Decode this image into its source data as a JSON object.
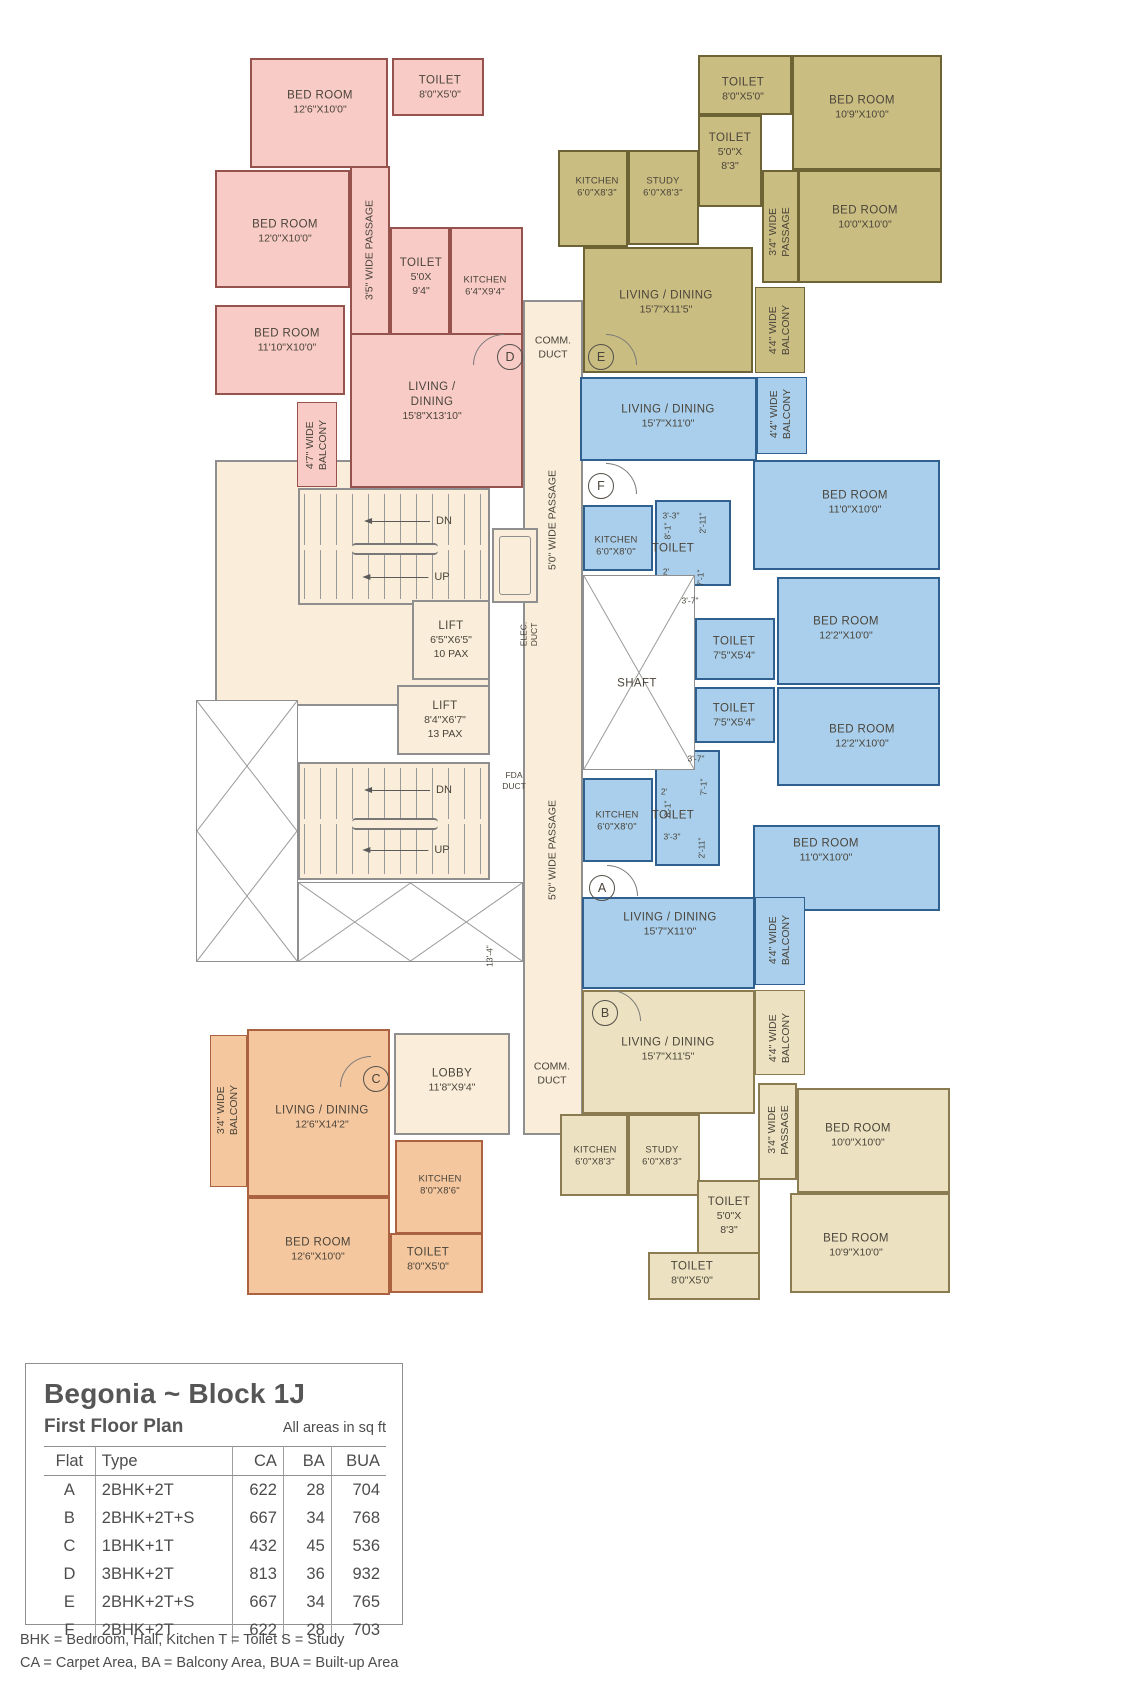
{
  "plan": {
    "flats": {
      "d": {
        "letter": "D",
        "bed1": {
          "name": "BED ROOM",
          "dims": "12'6\"X10'0\""
        },
        "toilet1": {
          "name": "TOILET",
          "dims": "8'0\"X5'0\""
        },
        "passage": "3'5\" WIDE PASSAGE",
        "bed2": {
          "name": "BED ROOM",
          "dims": "12'0\"X10'0\""
        },
        "toilet2": {
          "name": "TOILET",
          "l1": "5'0X",
          "l2": "9'4\""
        },
        "kitchen": {
          "name": "KITCHEN",
          "dims": "6'4\"X9'4\""
        },
        "bed3": {
          "name": "BED ROOM",
          "dims": "11'10\"X10'0\""
        },
        "balcony": "4'7\" WIDE\nBALCONY",
        "living": {
          "l1": "LIVING /",
          "l2": "DINING",
          "dims": "15'8\"X13'10\""
        }
      },
      "e": {
        "letter": "E",
        "toilet1": {
          "name": "TOILET",
          "dims": "8'0\"X5'0\""
        },
        "bed1": {
          "name": "BED ROOM",
          "dims": "10'9\"X10'0\""
        },
        "toilet2": {
          "name": "TOILET",
          "l1": "5'0\"X",
          "l2": "8'3\""
        },
        "kitchen": {
          "name": "KITCHEN",
          "dims": "6'0\"X8'3\""
        },
        "study": {
          "name": "STUDY",
          "dims": "6'0\"X8'3\""
        },
        "passage": "3'4\" WIDE\nPASSAGE",
        "bed2": {
          "name": "BED ROOM",
          "dims": "10'0\"X10'0\""
        },
        "living": {
          "l1": "LIVING / DINING",
          "dims": "15'7\"X11'5\""
        },
        "balcony": "4'4\" WIDE\nBALCONY"
      },
      "f": {
        "letter": "F",
        "living": {
          "l1": "LIVING / DINING",
          "dims": "15'7\"X11'0\""
        },
        "balcony": "4'4\" WIDE\nBALCONY",
        "bed1": {
          "name": "BED ROOM",
          "dims": "11'0\"X10'0\""
        },
        "kitchen": {
          "name": "KITCHEN",
          "dims": "6'0\"X8'0\""
        },
        "toilet": {
          "name": "TOILET",
          "d1": "3'-3\"",
          "d2": "8'-1\"",
          "d3": "2'-11\"",
          "d4": "2'",
          "d5": "7'-1\"",
          "d6": "3'-7\""
        },
        "toilet2": {
          "name": "TOILET",
          "dims": "7'5\"X5'4\""
        },
        "bed2": {
          "name": "BED ROOM",
          "dims": "12'2\"X10'0\""
        }
      },
      "a": {
        "letter": "A",
        "toilet2": {
          "name": "TOILET",
          "dims": "7'5\"X5'4\""
        },
        "bed1": {
          "name": "BED ROOM",
          "dims": "12'2\"X10'0\""
        },
        "kitchen": {
          "name": "KITCHEN",
          "dims": "6'0\"X8'0\""
        },
        "toilet": {
          "name": "TOILET",
          "d1": "3'-3\"",
          "d2": "8'-1\"",
          "d3": "2'-11\"",
          "d4": "2'",
          "d5": "7'-1\"",
          "d6": "3'-7\""
        },
        "bed2": {
          "name": "BED ROOM",
          "dims": "11'0\"X10'0\""
        },
        "living": {
          "l1": "LIVING / DINING",
          "dims": "15'7\"X11'0\""
        },
        "balcony": "4'4\" WIDE\nBALCONY"
      },
      "b": {
        "letter": "B",
        "living": {
          "l1": "LIVING / DINING",
          "dims": "15'7\"X11'5\""
        },
        "balcony": "4'4\" WIDE\nBALCONY",
        "kitchen": {
          "name": "KITCHEN",
          "dims": "6'0\"X8'3\""
        },
        "study": {
          "name": "STUDY",
          "dims": "6'0\"X8'3\""
        },
        "passage": "3'4\" WIDE\nPASSAGE",
        "bed1": {
          "name": "BED ROOM",
          "dims": "10'0\"X10'0\""
        },
        "toilet1": {
          "name": "TOILET",
          "l1": "5'0\"X",
          "l2": "8'3\""
        },
        "bed2": {
          "name": "BED ROOM",
          "dims": "10'9\"X10'0\""
        },
        "toilet2": {
          "name": "TOILET",
          "dims": "8'0\"X5'0\""
        }
      },
      "c": {
        "letter": "C",
        "balcony": "3'4\" WIDE\nBALCONY",
        "living": {
          "l1": "LIVING / DINING",
          "dims": "12'6\"X14'2\""
        },
        "kitchen": {
          "name": "KITCHEN",
          "dims": "8'0\"X8'6\""
        },
        "bed": {
          "name": "BED ROOM",
          "dims": "12'6\"X10'0\""
        },
        "toilet": {
          "name": "TOILET",
          "dims": "8'0\"X5'0\""
        }
      }
    },
    "core": {
      "comm_duct": "COMM.\nDUCT",
      "passage5": "5'0\" WIDE PASSAGE",
      "stairs": {
        "dn": "DN",
        "up": "UP"
      },
      "lift1": {
        "name": "LIFT",
        "dims": "6'5\"X6'5\"",
        "pax": "10 PAX"
      },
      "lift2": {
        "name": "LIFT",
        "dims": "8'4\"X6'7\"",
        "pax": "13 PAX"
      },
      "elec_duct": "ELEC.\nDUCT",
      "fda_duct": "FDA\nDUCT",
      "shaft": "SHAFT",
      "lobby": {
        "name": "LOBBY",
        "dims": "11'8\"X9'4\""
      },
      "dim_13_4": "13'-4\""
    }
  },
  "legend": {
    "title": "Begonia ~ Block 1J",
    "subtitle": "First Floor Plan",
    "note": "All areas in sq ft",
    "col_flat": "Flat",
    "col_type": "Type",
    "col_ca": "CA",
    "col_ba": "BA",
    "col_bua": "BUA",
    "rows": [
      [
        "A",
        "2BHK+2T",
        "622",
        "28",
        "704"
      ],
      [
        "B",
        "2BHK+2T+S",
        "667",
        "34",
        "768"
      ],
      [
        "C",
        "1BHK+1T",
        "432",
        "45",
        "536"
      ],
      [
        "D",
        "3BHK+2T",
        "813",
        "36",
        "932"
      ],
      [
        "E",
        "2BHK+2T+S",
        "667",
        "34",
        "765"
      ],
      [
        "F",
        "2BHK+2T",
        "622",
        "28",
        "703"
      ]
    ],
    "fn1": "BHK = Bedroom, Hall, Kitchen   T = Toilet   S = Study",
    "fn2": "CA = Carpet Area, BA = Balcony Area, BUA = Built-up Area"
  }
}
